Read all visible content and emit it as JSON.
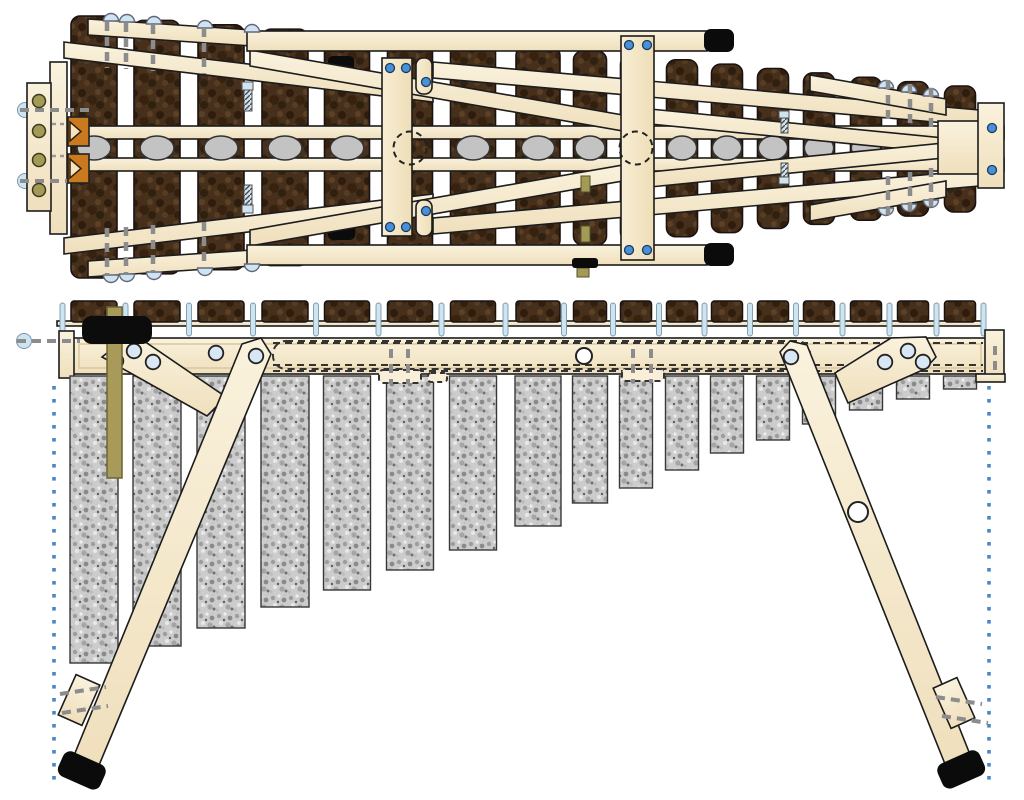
{
  "diagram": {
    "title": "marimba-construction-plan",
    "views": {
      "top": "plan-view",
      "side": "front-elevation-view"
    },
    "colors": {
      "wood_light": "#f9efd8",
      "wood_mid": "#f1e2bf",
      "wood_shadow": "#e2cfa6",
      "outline": "#1c1c1c",
      "bar_dark": "#46301c",
      "bar_darker": "#2e1c0d",
      "bar_light": "#5d4127",
      "tube_base": "#cbcbcb",
      "tube_dark": "#909090",
      "tube_light": "#ededed",
      "resonator_gray": "#c3c3c3",
      "screw_blue": "#4a90d9",
      "screw_blue_edge": "#1a3a5c",
      "pin_blue": "#cde4f2",
      "pin_blue_edge": "#7d97a6",
      "hole_blue": "#d9e6f4",
      "dash_gray": "#8c8c8c",
      "dot_blue": "#4a86c6",
      "olive": "#a39a55",
      "olive_edge": "#55512a",
      "khaki": "#a89a58",
      "orange": "#c97a1e",
      "black": "#0b0b0b",
      "white": "#ffffff"
    },
    "stations": [
      {
        "x": 94,
        "bar_w": 46,
        "tube_bottom": 663
      },
      {
        "x": 157,
        "bar_w": 46,
        "tube_bottom": 646
      },
      {
        "x": 221,
        "bar_w": 46,
        "tube_bottom": 628
      },
      {
        "x": 285,
        "bar_w": 46,
        "tube_bottom": 607
      },
      {
        "x": 347,
        "bar_w": 45,
        "tube_bottom": 590
      },
      {
        "x": 410,
        "bar_w": 45,
        "tube_bottom": 570
      },
      {
        "x": 473,
        "bar_w": 45,
        "tube_bottom": 550
      },
      {
        "x": 538,
        "bar_w": 44,
        "tube_bottom": 526
      },
      {
        "x": 590,
        "bar_w": 33,
        "tube_bottom": 503
      },
      {
        "x": 636,
        "bar_w": 31,
        "tube_bottom": 488
      },
      {
        "x": 682,
        "bar_w": 31,
        "tube_bottom": 470
      },
      {
        "x": 727,
        "bar_w": 31,
        "tube_bottom": 453
      },
      {
        "x": 773,
        "bar_w": 31,
        "tube_bottom": 440
      },
      {
        "x": 819,
        "bar_w": 31,
        "tube_bottom": 424
      },
      {
        "x": 866,
        "bar_w": 31,
        "tube_bottom": 410
      },
      {
        "x": 913,
        "bar_w": 31,
        "tube_bottom": 399
      },
      {
        "x": 960,
        "bar_w": 31,
        "tube_bottom": 389
      }
    ],
    "top_view": {
      "center_y": 148,
      "bar_top_first": 16,
      "bar_top_last": 86,
      "bar_bottom_first": 278,
      "bar_bottom_last": 212,
      "rail_a": {
        "x": 60,
        "y": 126,
        "w": 944,
        "h": 13
      },
      "rail_b": {
        "x": 60,
        "y": 158,
        "w": 944,
        "h": 13
      },
      "resonator_ry": 12,
      "dashed_stations": [
        5,
        9
      ],
      "dashed_circle_r": 16.5,
      "screw_dashes": [
        [
          107,
          22,
          68
        ],
        [
          126,
          23,
          69
        ],
        [
          153,
          25,
          71
        ],
        [
          204,
          28,
          74
        ],
        [
          107,
          228,
          274
        ],
        [
          126,
          227,
          273
        ],
        [
          153,
          225,
          271
        ],
        [
          204,
          222,
          268
        ],
        [
          888,
          80,
          120
        ],
        [
          910,
          84,
          124
        ],
        [
          931,
          88,
          128
        ],
        [
          888,
          176,
          216
        ],
        [
          910,
          172,
          212
        ],
        [
          931,
          168,
          208
        ]
      ],
      "domes": [
        {
          "x": 111,
          "y": 21,
          "dir": "up"
        },
        {
          "x": 127,
          "y": 22,
          "dir": "up"
        },
        {
          "x": 154,
          "y": 24,
          "dir": "up"
        },
        {
          "x": 205,
          "y": 28,
          "dir": "up"
        },
        {
          "x": 252,
          "y": 32,
          "dir": "up"
        },
        {
          "x": 111,
          "y": 275,
          "dir": "down"
        },
        {
          "x": 127,
          "y": 274,
          "dir": "down"
        },
        {
          "x": 154,
          "y": 272,
          "dir": "down"
        },
        {
          "x": 205,
          "y": 268,
          "dir": "down"
        },
        {
          "x": 252,
          "y": 264,
          "dir": "down"
        },
        {
          "x": 886,
          "y": 88,
          "dir": "up"
        },
        {
          "x": 909,
          "y": 92,
          "dir": "up"
        },
        {
          "x": 931,
          "y": 96,
          "dir": "up"
        },
        {
          "x": 886,
          "y": 208,
          "dir": "down"
        },
        {
          "x": 909,
          "y": 204,
          "dir": "down"
        },
        {
          "x": 931,
          "y": 200,
          "dir": "down"
        }
      ],
      "screw_dots": [
        [
          390,
          68
        ],
        [
          406,
          68
        ],
        [
          390,
          227
        ],
        [
          406,
          227
        ],
        [
          426,
          82
        ],
        [
          426,
          211
        ],
        [
          629,
          45
        ],
        [
          647,
          45
        ],
        [
          629,
          250
        ],
        [
          647,
          250
        ],
        [
          992,
          128
        ],
        [
          992,
          170
        ]
      ],
      "olive_holes": [
        [
          39,
          101
        ],
        [
          39,
          131
        ],
        [
          39,
          160
        ],
        [
          39,
          190
        ]
      ]
    },
    "side_view": {
      "bar_y": 301,
      "bar_h": 21,
      "bed": {
        "x": 57,
        "y": 321,
        "w": 928,
        "h": 5
      },
      "pin_w": 5,
      "pin_y": 303,
      "pin_h": 33,
      "rail": {
        "x": 73,
        "y": 338,
        "w": 914,
        "h": 36
      },
      "tube_top": 376,
      "blue_holes": [
        [
          116,
          361
        ],
        [
          134,
          351
        ],
        [
          153,
          362
        ],
        [
          216,
          353
        ],
        [
          256,
          356
        ],
        [
          791,
          357
        ],
        [
          885,
          362
        ],
        [
          908,
          351
        ],
        [
          923,
          362
        ]
      ],
      "white_holes": [
        [
          584,
          356
        ],
        [
          858,
          512
        ]
      ],
      "dotted_left_x": 54,
      "dotted_right_x": 989,
      "dotted_top": 386,
      "dotted_bottom": 780,
      "dot_size": 3.6,
      "dot_step": 13
    }
  }
}
